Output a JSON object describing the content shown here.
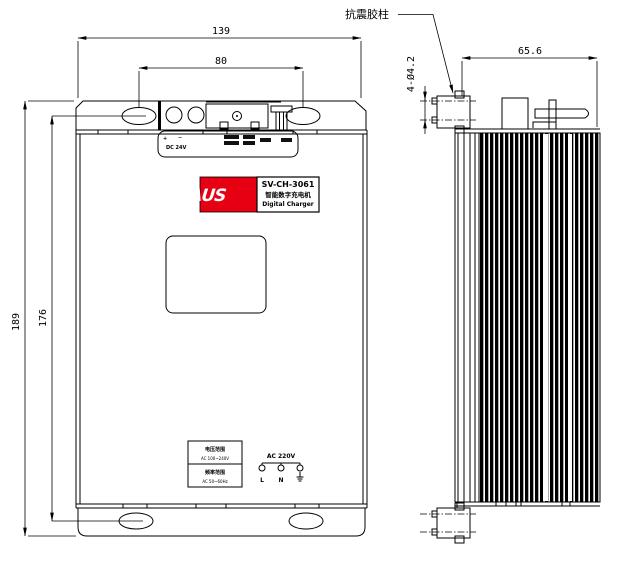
{
  "labels": {
    "shock_pad": "抗震胶柱"
  },
  "dimensions": {
    "width_total": "139",
    "hole_span_h": "80",
    "height_total": "189",
    "hole_span_v": "176",
    "depth": "65.6",
    "mount_holes": "4-Ø4.2"
  },
  "panel": {
    "plus": "+",
    "minus": "−",
    "dc": "DC 24V"
  },
  "nameplate": {
    "brand": "ΛUS",
    "model": "SV-CH-3061",
    "name_cn": "智能数字充电机",
    "name_en": "Digital Charger"
  },
  "spec_table": {
    "rows": [
      {
        "header": "电压范围",
        "value": "AC 100~240V"
      },
      {
        "header": "频率范围",
        "value": "AC 50~60Hz"
      }
    ]
  },
  "ac": {
    "label": "AC 220V",
    "l": "L",
    "n": "N",
    "pe": "⏚"
  },
  "colors": {
    "line": "#000000",
    "logo_red": "#e60012",
    "background": "#ffffff"
  }
}
